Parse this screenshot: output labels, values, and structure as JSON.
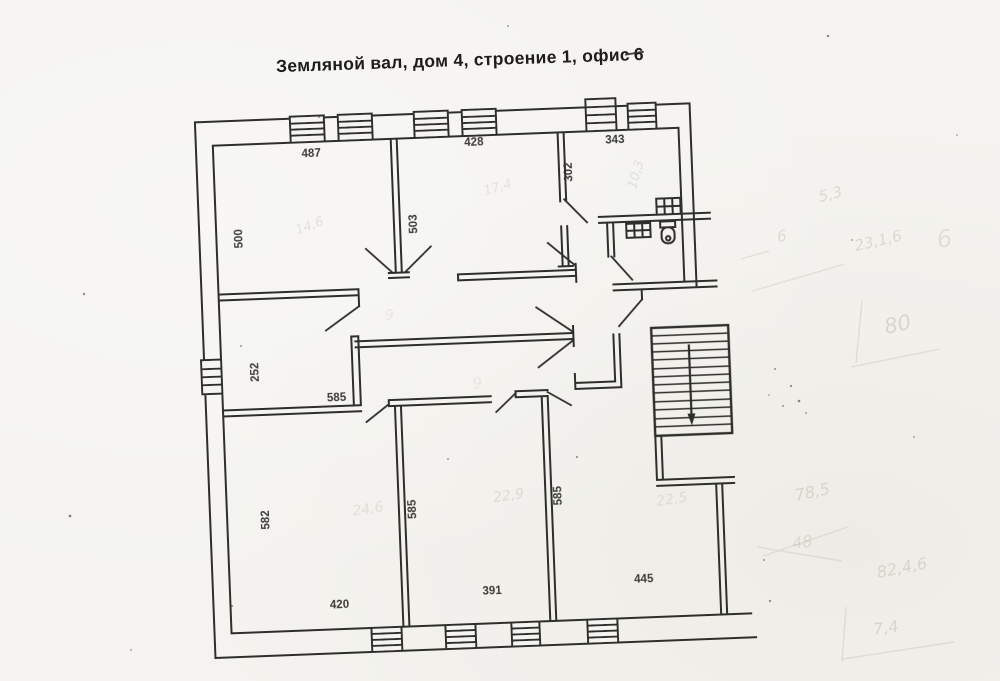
{
  "document": {
    "title_prefix": "Земляной вал, дом 4, строение 1, офис",
    "office_number": "6"
  },
  "floor_plan": {
    "dimension_labels": {
      "top_left_room_width": "487",
      "top_middle_room_width": "428",
      "top_right_room_width": "343",
      "left_wall_upper": "500",
      "center_partition_upper": "503",
      "right_partition_upper": "302",
      "left_corridor": "252",
      "corridor_wall": "585",
      "left_wall_lower": "582",
      "lower_partition_left": "585",
      "lower_partition_right": "585",
      "bottom_left_room_width": "420",
      "bottom_middle_room_width": "391",
      "bottom_right_room_width": "445"
    },
    "pencil_notes": {
      "room_top_left": "14,6",
      "room_top_middle": "17,4",
      "room_top_right": "10,3",
      "room_bottom_left": "24,6",
      "room_bottom_middle": "22,9",
      "room_bottom_right": "22,5",
      "corridor_a": "9",
      "corridor_b": "9"
    }
  },
  "margin_notes": {
    "top_a": "5,3",
    "top_b": "6",
    "top_c": "23,1,6",
    "top_d": "6",
    "top_e": "80",
    "bottom_a": "78,5",
    "bottom_b": "48",
    "bottom_c": "82,4,6",
    "bottom_d": "7,4"
  }
}
